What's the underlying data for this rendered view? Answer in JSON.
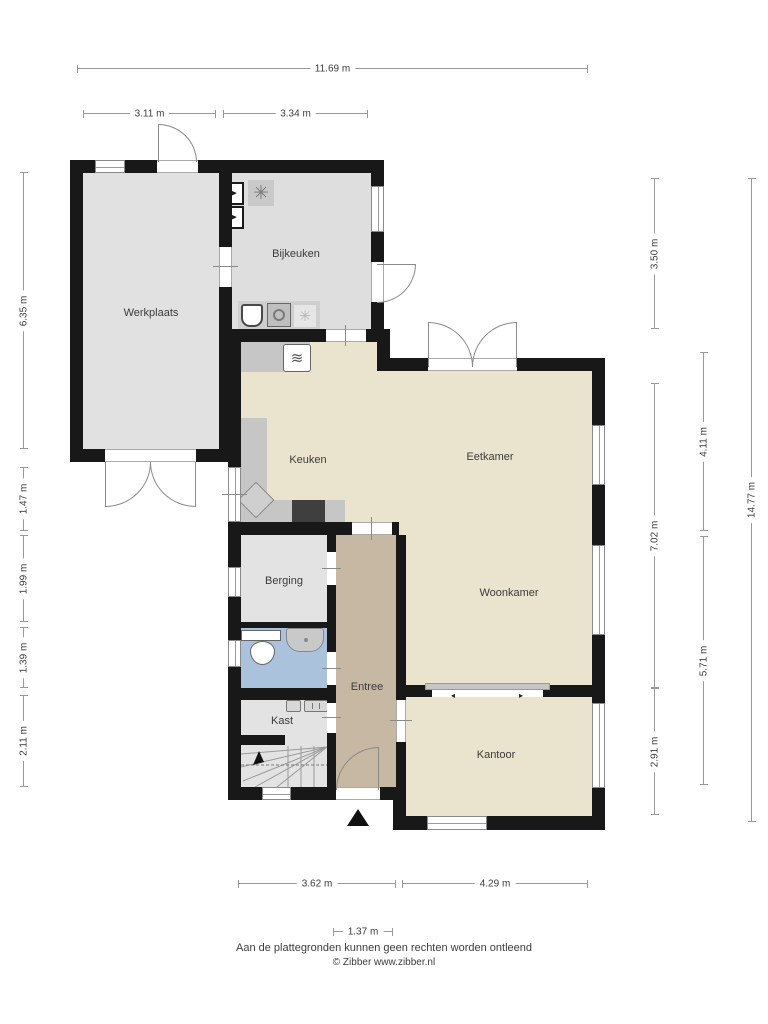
{
  "plan": {
    "type": "floorplan-ground-floor",
    "rooms": {
      "werkplaats": "Werkplaats",
      "bijkeuken": "Bijkeuken",
      "keuken": "Keuken",
      "eetkamer": "Eetkamer",
      "woonkamer": "Woonkamer",
      "berging": "Berging",
      "entree": "Entree",
      "kast": "Kast",
      "kantoor": "Kantoor"
    },
    "dims": {
      "total_width": "11.69 m",
      "werkplaats_width": "3.11 m",
      "bijkeuken_width": "3.34 m",
      "werkplaats_depth": "6.35 m",
      "keuken_left": "1.47 m",
      "berging_depth": "1.99 m",
      "toilet_depth": "1.39 m",
      "kast_depth": "2.11 m",
      "bijkeuken_depth": "3.50 m",
      "middle_right_depth": "7.02 m",
      "kantoor_depth": "2.91 m",
      "eetkamer_depth": "4.11 m",
      "woonkamer_depth": "5.71 m",
      "total_depth": "14.77 m",
      "bottom_left_width": "3.62 m",
      "kantoor_width": "4.29 m",
      "entree_width": "1.37 m"
    },
    "footer": {
      "disclaimer": "Aan de plattegronden kunnen geen rechten worden ontleend",
      "copyright": "© Zibber www.zibber.nl"
    },
    "colors": {
      "wall": "#181818",
      "living_floor": "#eae3cd",
      "utility_floor": "#e2e2e2",
      "hall_floor": "#c6b8a2",
      "bathroom_floor": "#abc2dd",
      "counter": "#c6c6c6",
      "island_dark": "#3f3f3f"
    },
    "icons": [
      "washing-machine-icon",
      "tumble-dryer-icon",
      "mechanical-ventilation-icon",
      "laundry-sink-icon",
      "washer-drum-icon",
      "fan-icon",
      "stove-icon",
      "kitchen-sink-icon",
      "toilet-icon",
      "washbasin-icon",
      "water-meter-icon",
      "electricity-meter-icon",
      "stairs",
      "entrance-marker"
    ],
    "glyphs": {
      "fan": "✳",
      "appliance_arrow": "➤",
      "stove_waves": "≋",
      "slide_left": "◂",
      "slide_right": "▸"
    }
  }
}
